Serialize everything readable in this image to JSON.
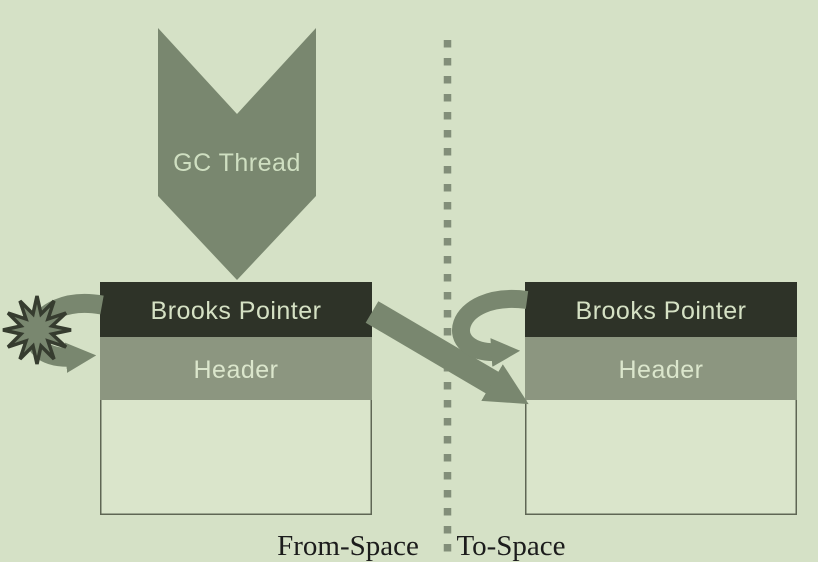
{
  "colors": {
    "background": "#d5e1c6",
    "shape": "#79876f",
    "shape_shadow": "#6f7d67",
    "shape_text": "#cfdfc1",
    "pointer_band": "#2e3328",
    "pointer_band_text": "#d5e1c4",
    "header_band": "#8c9680",
    "header_band_text": "#dbe6cc",
    "object_body": "#dae5cb",
    "object_border": "#5f6654",
    "divider": "#828e79",
    "region_label": "#1c1c1c",
    "star_outline": "#363c2f"
  },
  "gc_thread": {
    "label": "GC Thread"
  },
  "from_space": {
    "region_label": "From-Space",
    "object": {
      "pointer_label": "Brooks Pointer",
      "header_label": "Header"
    }
  },
  "to_space": {
    "region_label": "To-Space",
    "object": {
      "pointer_label": "Brooks Pointer",
      "header_label": "Header"
    }
  }
}
